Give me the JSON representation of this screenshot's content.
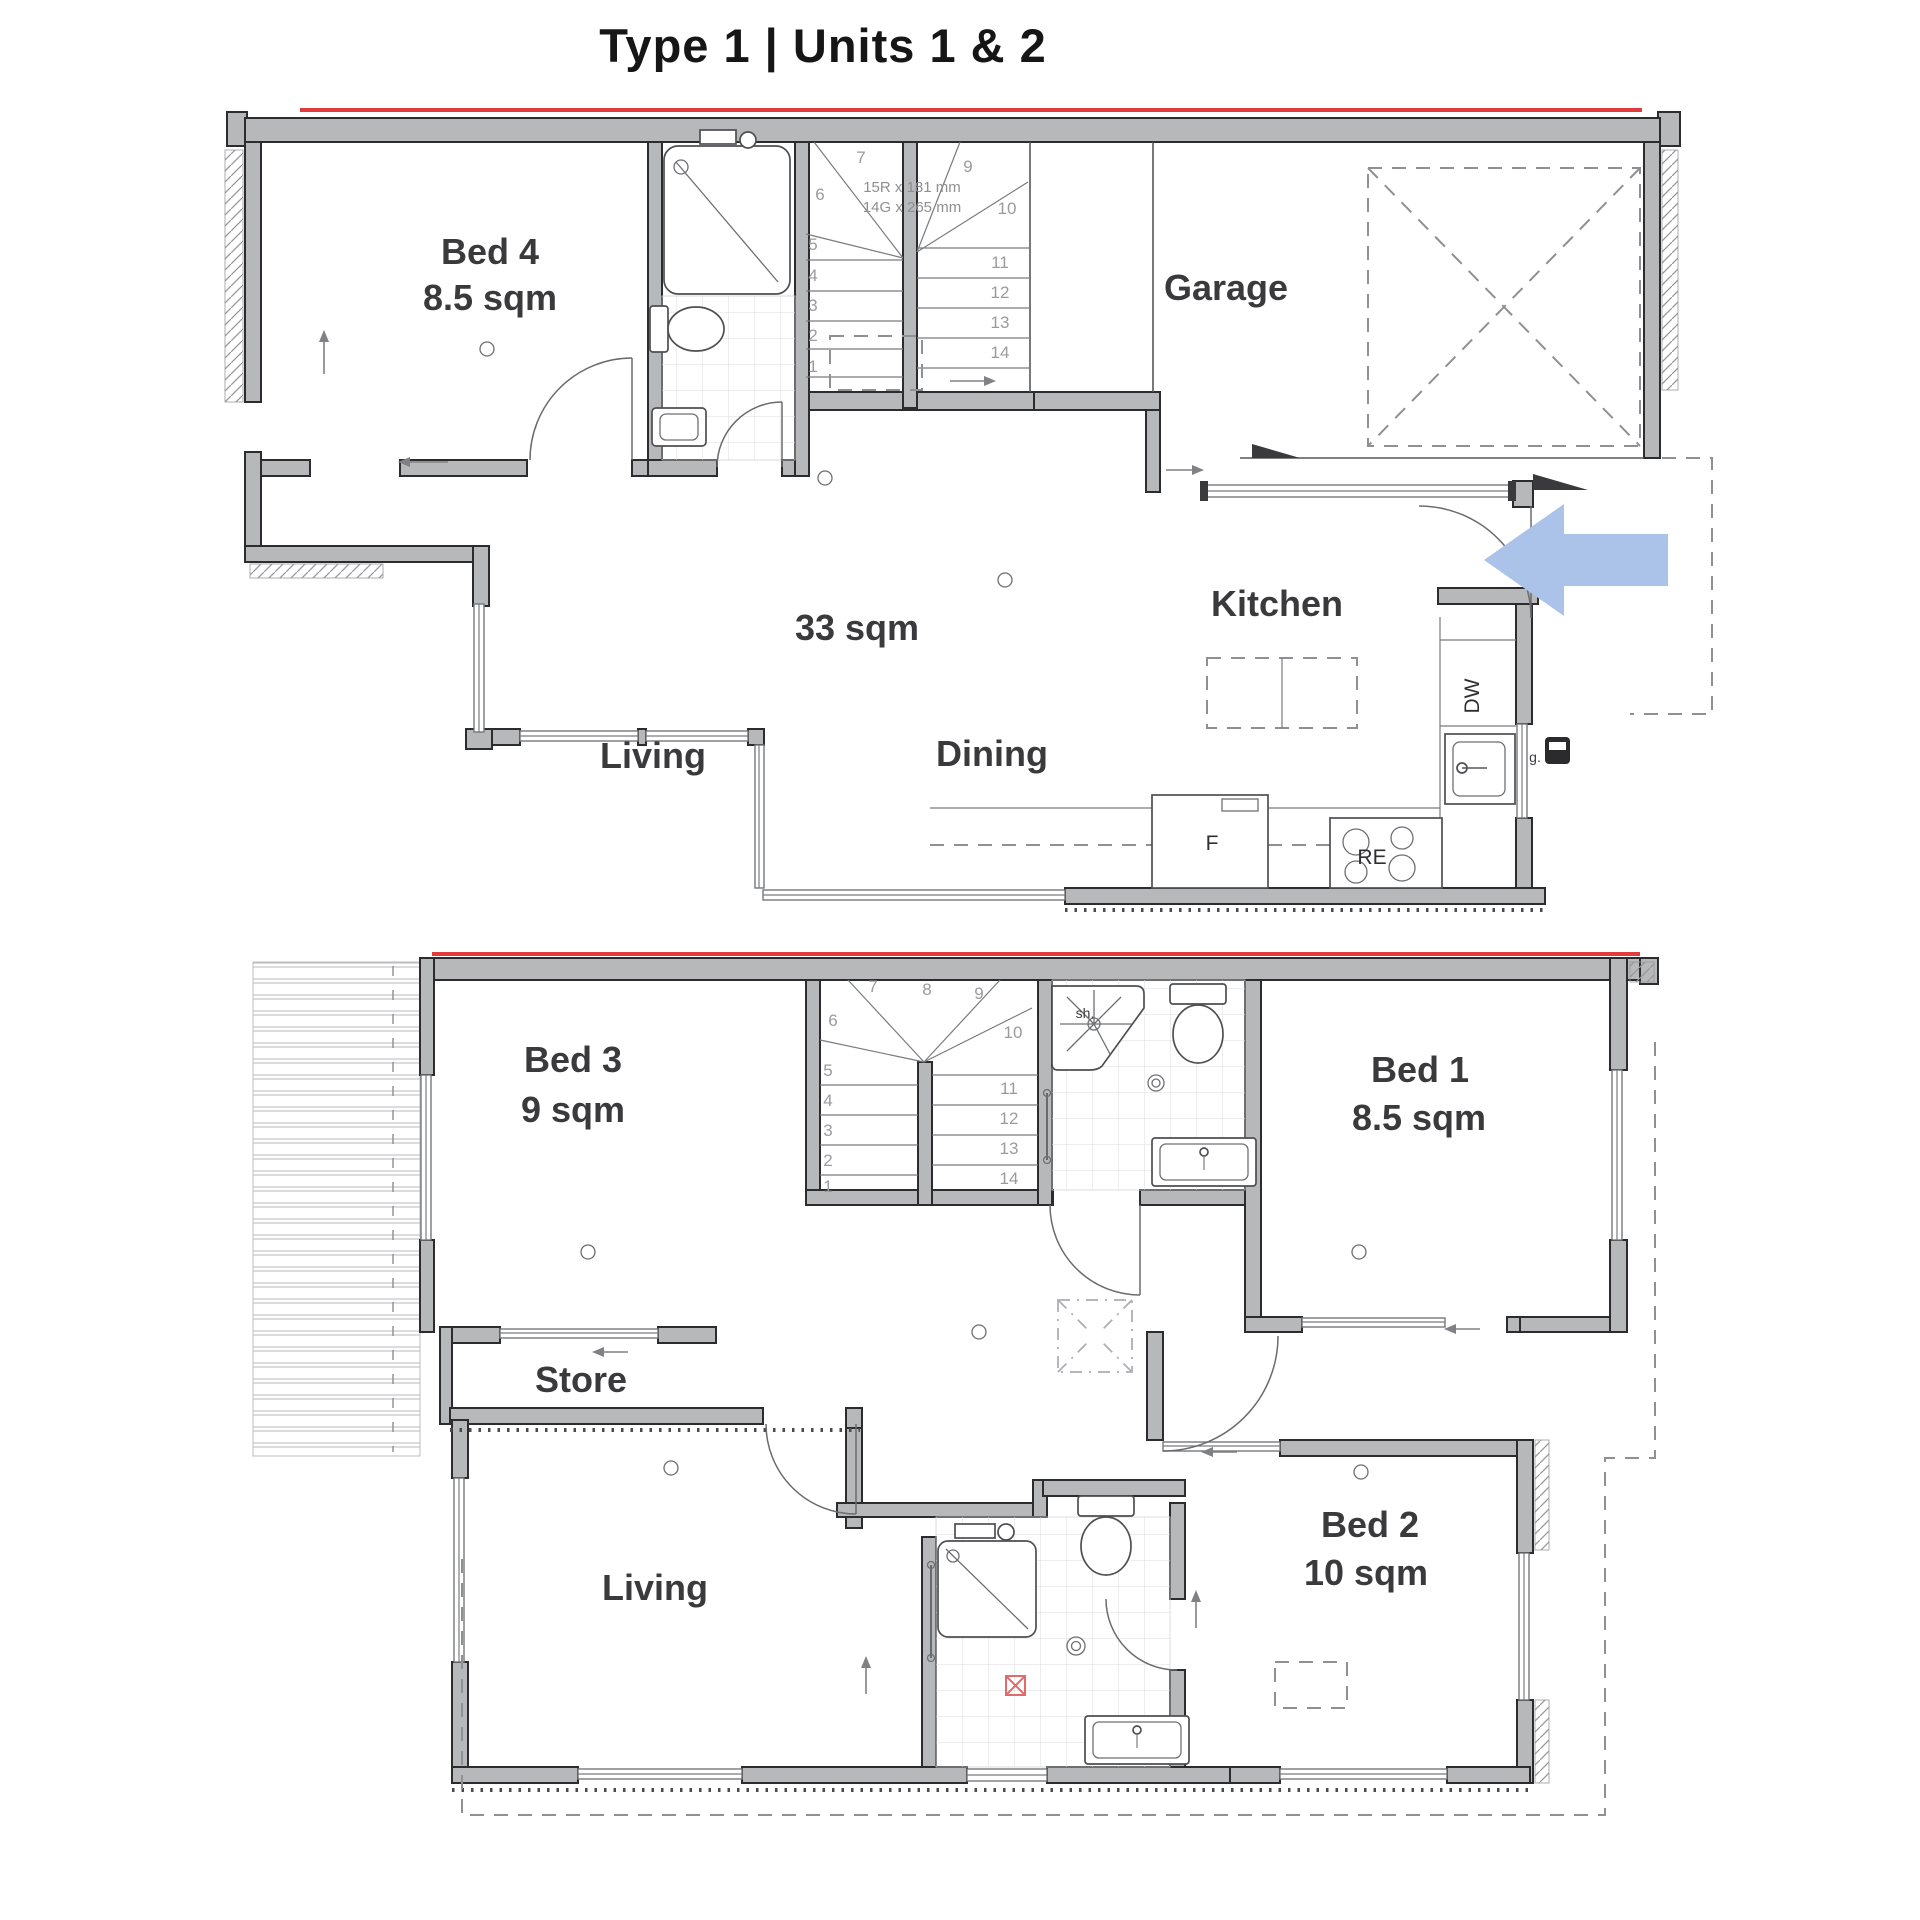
{
  "title": "Type 1 | Units 1 & 2",
  "colors": {
    "accent_red": "#e03c3c",
    "arrow_blue": "#abc3e8",
    "marker_red": "#e26a6a",
    "wall_gray": "#b7b8b9",
    "label_dark": "#3a3a3c"
  },
  "upper_plan": {
    "bed4_name": "Bed 4",
    "bed4_area": "8.5 sqm",
    "garage_label": "Garage",
    "kitchen_label": "Kitchen",
    "area_label": "33 sqm",
    "living_label": "Living",
    "dining_label": "Dining",
    "stair_note_1": "15R x 181 mm",
    "stair_note_2": "14G x 265 mm",
    "appliance_dw": "DW",
    "appliance_fridge": "F",
    "appliance_range": "RE",
    "gas_label": "g.",
    "stair_numbers": [
      "1",
      "2",
      "3",
      "4",
      "5",
      "6",
      "7",
      "9",
      "10",
      "11",
      "12",
      "13",
      "14"
    ]
  },
  "lower_plan": {
    "bed3_name": "Bed 3",
    "bed3_area": "9 sqm",
    "bed1_name": "Bed 1",
    "bed1_area": "8.5 sqm",
    "bed2_name": "Bed 2",
    "bed2_area": "10 sqm",
    "store_label": "Store",
    "living_label": "Living",
    "shower_label": "sh.",
    "stair_numbers": [
      "1",
      "2",
      "3",
      "4",
      "5",
      "6",
      "7",
      "8",
      "9",
      "10",
      "11",
      "12",
      "13",
      "14"
    ]
  }
}
